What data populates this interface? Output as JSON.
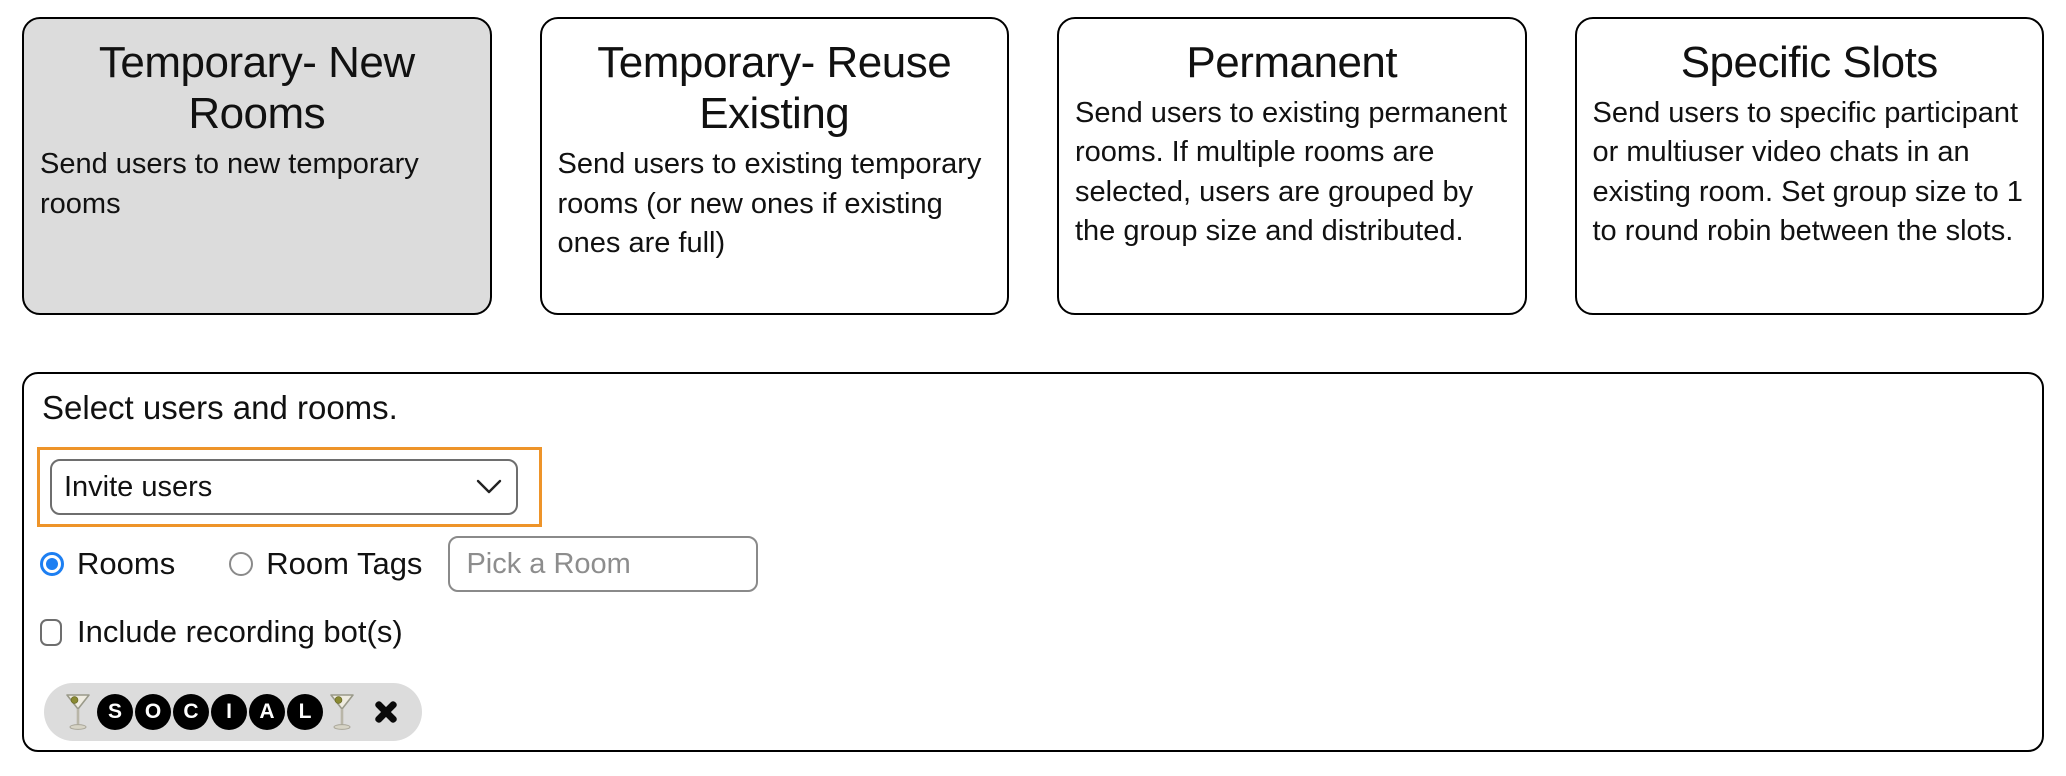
{
  "methods": {
    "cards": [
      {
        "title": "Temporary- New Rooms",
        "description": "Send users to new temporary rooms",
        "selected": true
      },
      {
        "title": "Temporary- Reuse Existing",
        "description": "Send users to existing temporary rooms (or new ones if existing ones are full)",
        "selected": false
      },
      {
        "title": "Permanent",
        "description": "Send users to existing permanent rooms. If multiple rooms are selected, users are grouped by the group size and distributed.",
        "selected": false
      },
      {
        "title": "Specific Slots",
        "description": "Send users to specific participant or multiuser video chats in an existing room. Set group size to 1 to round robin between the slots.",
        "selected": false
      }
    ]
  },
  "panel": {
    "heading": "Select users and rooms.",
    "user_select": {
      "value": "Invite users"
    },
    "room_mode": {
      "options": [
        {
          "label": "Rooms",
          "selected": true
        },
        {
          "label": "Room Tags",
          "selected": false
        }
      ]
    },
    "room_picker": {
      "placeholder": "Pick a Room"
    },
    "recording_checkbox": {
      "label": "Include recording bot(s)",
      "checked": false
    },
    "selected_room_chip": {
      "emoji_left": "🍸",
      "letters": [
        "S",
        "O",
        "C",
        "I",
        "A",
        "L"
      ],
      "emoji_right": "🍸",
      "close_label": "×"
    }
  },
  "colors": {
    "accent_orange": "#ee9429",
    "radio_blue": "#1d7ff2",
    "selected_card_bg": "#dcdcdc",
    "chip_bg": "#dcdcdc",
    "border_black": "#000000",
    "placeholder_gray": "#8d8d8d"
  }
}
